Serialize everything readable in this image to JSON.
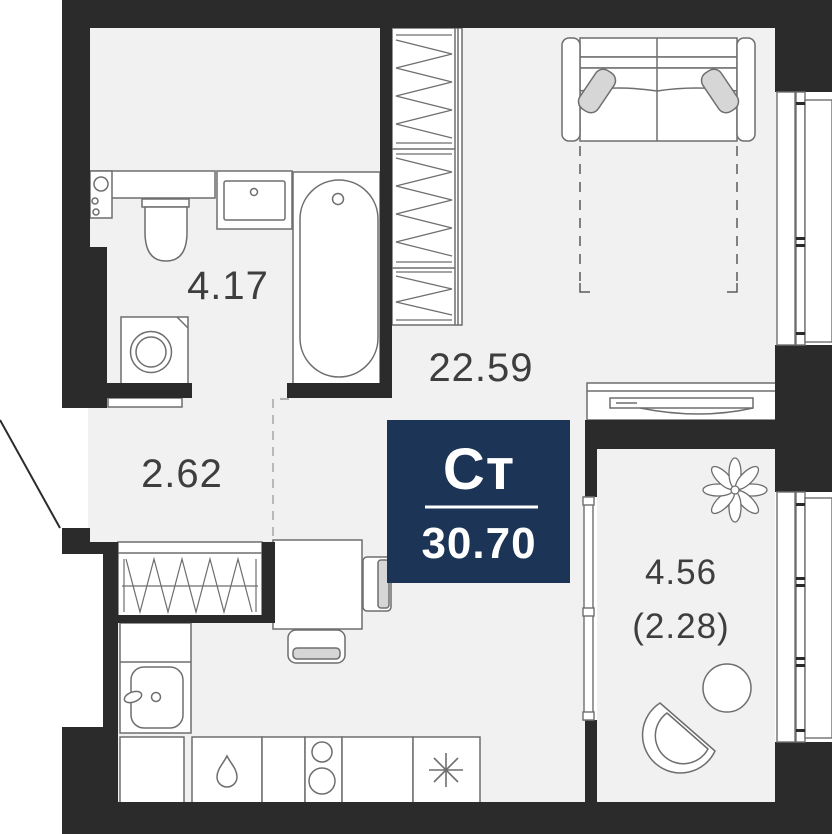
{
  "plan": {
    "badge": {
      "type_label": "Ст",
      "area_value": "30.70"
    },
    "rooms": {
      "bathroom": {
        "area": "4.17"
      },
      "living": {
        "area": "22.59"
      },
      "hallway": {
        "area": "2.62"
      },
      "balcony": {
        "area": "4.56",
        "area_reduced": "(2.28)"
      }
    },
    "colors": {
      "wall": "#2b2b2b",
      "floor": "#f0f1f0",
      "badge_bg": "#1c3455",
      "badge_text": "#ffffff",
      "fixture_stroke": "#6e6e6e",
      "label_text": "#3e3e3e",
      "soft_fill": "#d6d6d6"
    }
  }
}
